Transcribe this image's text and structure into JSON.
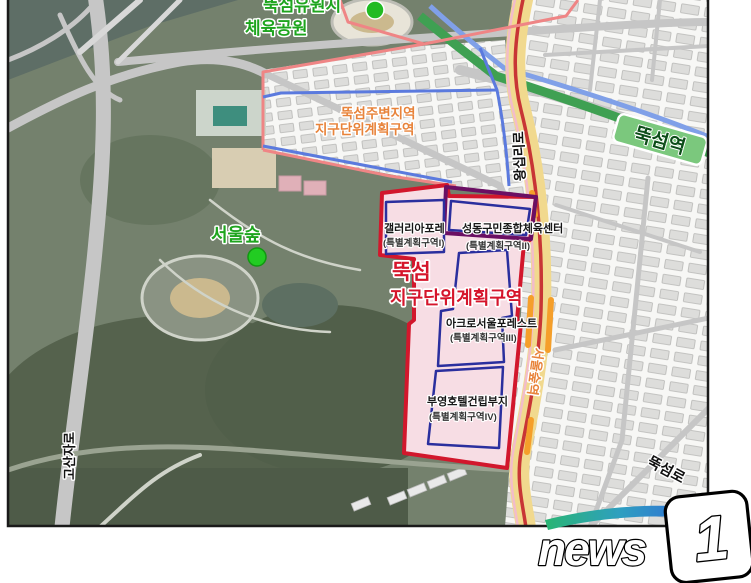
{
  "map": {
    "labels": {
      "park_top_line1": "뚝섬유원지",
      "park_top_line2": "체육공원",
      "surrounding_line1": "뚝섬주변지역",
      "surrounding_line2": "지구단위계획구역",
      "seoul_forest": "서울숲",
      "district_title_line1": "뚝섬",
      "district_title_line2": "지구단위계획구역",
      "zone1_name": "갤러리아포레",
      "zone1_sub": "(특별계획구역I)",
      "zone2_name": "성동구민종합체육센터",
      "zone2_sub": "(특별계획구역II)",
      "zone3_name": "아크로서울포레스트",
      "zone3_sub": "(특별계획구역III)",
      "zone4_name": "부영호텔건립부지",
      "zone4_sub": "(특별계획구역IV)",
      "station_ttukseom": "뚝섬역",
      "station_seoulsup": "서울숲역",
      "road_wangsimni": "왕십리로",
      "road_gosanja": "고산자로",
      "road_ttukseom": "뚝섬로"
    },
    "colors": {
      "district_border": "#d2172c",
      "district_fill": "#f7dde4",
      "special_zone_border": "#2a2f9e",
      "sports_center_border": "#6b0f63",
      "surrounding_zone_border": "#5b7ade",
      "park_zone_border": "#ef8585",
      "subway_line2_green": "#3fa052",
      "bundang_line_yellow": "#f1d98e",
      "label_green": "#1ea51e",
      "label_orange": "#e8833a"
    }
  },
  "watermark": {
    "brand_text": "news",
    "brand_number": "1"
  }
}
